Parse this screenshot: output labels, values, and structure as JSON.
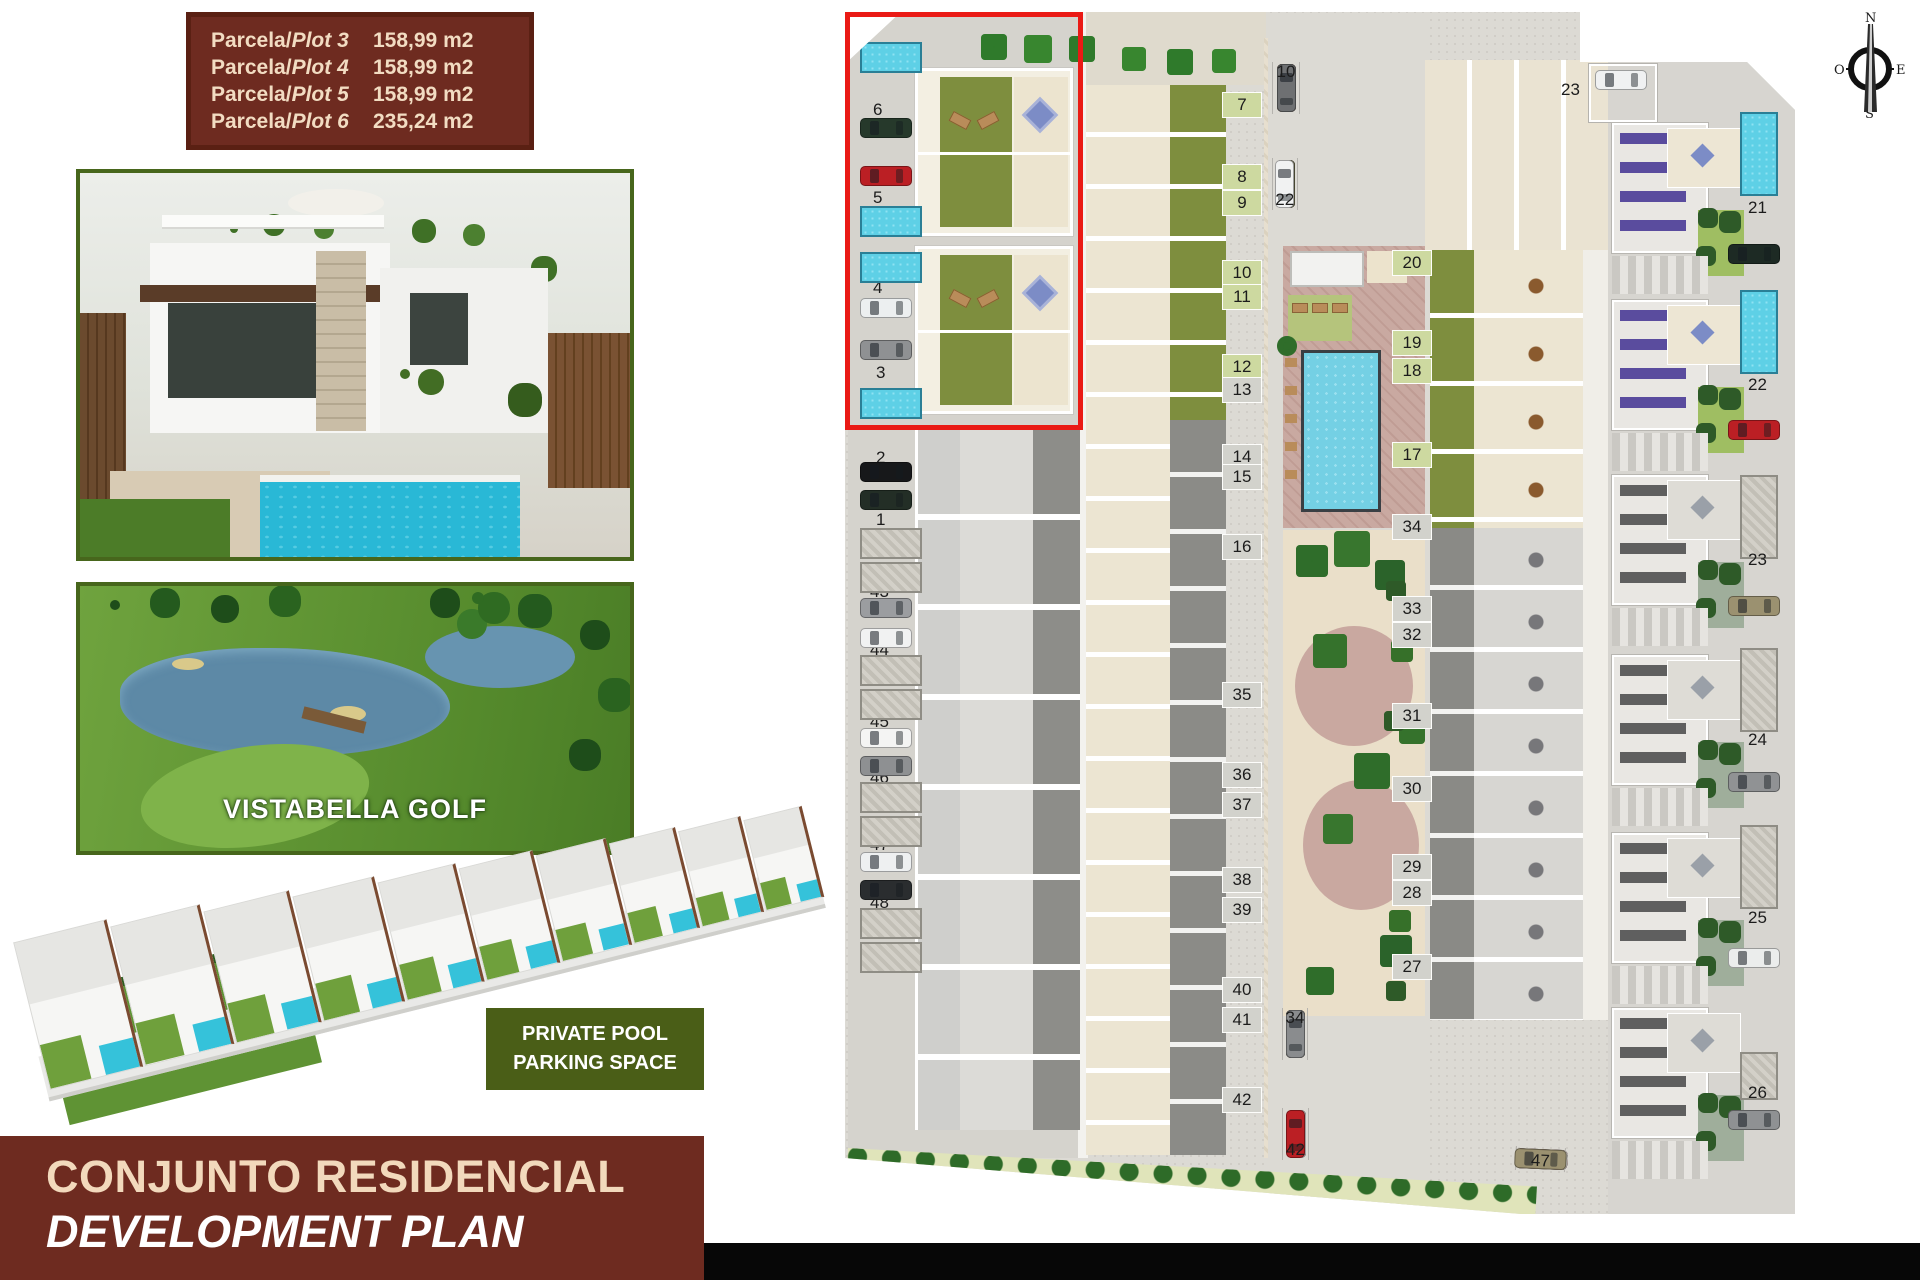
{
  "title_block": {
    "rows": [
      {
        "prefix": "Parcela/",
        "plot": "Plot 3",
        "area": "158,99  m2"
      },
      {
        "prefix": "Parcela/",
        "plot": "Plot 4",
        "area": "158,99  m2"
      },
      {
        "prefix": "Parcela/",
        "plot": "Plot 5",
        "area": "158,99  m2"
      },
      {
        "prefix": "Parcela/",
        "plot": "Plot 6",
        "area": "235,24  m2"
      }
    ]
  },
  "golf_photo": {
    "caption": "VISTABELLA GOLF"
  },
  "feature_box": {
    "line1": "PRIVATE POOL",
    "line2": "PARKING SPACE"
  },
  "footer": {
    "title_es": "CONJUNTO RESIDENCIAL",
    "title_en": "DEVELOPMENT PLAN"
  },
  "compass": {
    "north": "N",
    "south": "S",
    "east": "E",
    "west": "O"
  },
  "colors": {
    "brand_brown": "#6e2b20",
    "cream_text": "#f2d9bc",
    "olive_green": "#4a5e17",
    "highlight_red": "#ea1a15",
    "pool_blue": "#5ed0e6",
    "garden_green": "#7e8e3e"
  },
  "plan": {
    "top_right_parking": {
      "n": "23"
    },
    "highlight_plots": [
      "3",
      "4",
      "5",
      "6"
    ],
    "left_labels": [
      {
        "n": "6",
        "x": 30,
        "y": 92
      },
      {
        "n": "5",
        "x": 30,
        "y": 180
      },
      {
        "n": "4",
        "x": 30,
        "y": 270
      },
      {
        "n": "3",
        "x": 33,
        "y": 355
      },
      {
        "n": "2",
        "x": 33,
        "y": 440
      },
      {
        "n": "1",
        "x": 33,
        "y": 502
      },
      {
        "n": "43",
        "x": 27,
        "y": 574
      },
      {
        "n": "44",
        "x": 27,
        "y": 632
      },
      {
        "n": "45",
        "x": 27,
        "y": 704
      },
      {
        "n": "46",
        "x": 27,
        "y": 760
      },
      {
        "n": "47",
        "x": 27,
        "y": 827
      },
      {
        "n": "48",
        "x": 27,
        "y": 885
      }
    ],
    "left_cars": [
      {
        "x": 17,
        "y": 110,
        "c": "#26392b"
      },
      {
        "x": 17,
        "y": 158,
        "c": "#bb1f24"
      },
      {
        "x": 17,
        "y": 290,
        "c": "#eceff0"
      },
      {
        "x": 17,
        "y": 332,
        "c": "#8f9193"
      },
      {
        "x": 17,
        "y": 454,
        "c": "#17181a"
      },
      {
        "x": 17,
        "y": 482,
        "c": "#232e26"
      },
      {
        "x": 17,
        "y": 590,
        "c": "#9b9da0"
      },
      {
        "x": 17,
        "y": 620,
        "c": "#f1f2f2"
      },
      {
        "x": 17,
        "y": 720,
        "c": "#f4f4f3"
      },
      {
        "x": 17,
        "y": 748,
        "c": "#8e9092"
      },
      {
        "x": 17,
        "y": 844,
        "c": "#eef0f1"
      },
      {
        "x": 17,
        "y": 872,
        "c": "#2a2d2f"
      }
    ],
    "left_pools": [
      {
        "x": 17,
        "y": 34,
        "cls": "b"
      },
      {
        "x": 17,
        "y": 198,
        "cls": "b"
      },
      {
        "x": 17,
        "y": 244,
        "cls": "b"
      },
      {
        "x": 17,
        "y": 380,
        "cls": "b"
      },
      {
        "x": 17,
        "y": 520,
        "cls": "g"
      },
      {
        "x": 17,
        "y": 554,
        "cls": "g"
      },
      {
        "x": 17,
        "y": 647,
        "cls": "g"
      },
      {
        "x": 17,
        "y": 681,
        "cls": "g"
      },
      {
        "x": 17,
        "y": 774,
        "cls": "g"
      },
      {
        "x": 17,
        "y": 808,
        "cls": "g"
      },
      {
        "x": 17,
        "y": 900,
        "cls": "g"
      },
      {
        "x": 17,
        "y": 934,
        "cls": "g"
      }
    ],
    "hl_buildings": [
      {
        "y": 60
      },
      {
        "y": 238
      }
    ],
    "mid_tabs": [
      {
        "n": "7",
        "y": 84,
        "g": 1
      },
      {
        "n": "8",
        "y": 156,
        "g": 1
      },
      {
        "n": "9",
        "y": 182,
        "g": 1
      },
      {
        "n": "10",
        "y": 252,
        "g": 1
      },
      {
        "n": "11",
        "y": 276,
        "g": 1
      },
      {
        "n": "12",
        "y": 346,
        "g": 1
      },
      {
        "n": "13",
        "y": 369
      },
      {
        "n": "14",
        "y": 436
      },
      {
        "n": "15",
        "y": 456
      },
      {
        "n": "16",
        "y": 526
      },
      {
        "n": "35",
        "y": 674
      },
      {
        "n": "36",
        "y": 754
      },
      {
        "n": "37",
        "y": 784
      },
      {
        "n": "38",
        "y": 859
      },
      {
        "n": "39",
        "y": 889
      },
      {
        "n": "40",
        "y": 969
      },
      {
        "n": "41",
        "y": 999
      },
      {
        "n": "42",
        "y": 1079
      }
    ],
    "cr_tabs": [
      {
        "n": "20",
        "y": 242,
        "g": 1
      },
      {
        "n": "19",
        "y": 322,
        "g": 1
      },
      {
        "n": "18",
        "y": 350,
        "g": 1
      },
      {
        "n": "17",
        "y": 434,
        "g": 1
      },
      {
        "n": "34",
        "y": 506
      },
      {
        "n": "33",
        "y": 588
      },
      {
        "n": "32",
        "y": 614
      },
      {
        "n": "31",
        "y": 695
      },
      {
        "n": "30",
        "y": 768
      },
      {
        "n": "29",
        "y": 846
      },
      {
        "n": "28",
        "y": 872
      },
      {
        "n": "27",
        "y": 946
      }
    ],
    "park_row1": [
      {
        "n": "1",
        "c": "#bb1f24"
      },
      {
        "n": "2",
        "c": "#f1f2f2"
      },
      {
        "n": "3",
        "c": "#9b9170"
      },
      {
        "n": "4",
        "c": "#6e7072"
      },
      {
        "n": "5",
        "c": "#f1f2f2"
      },
      {
        "n": "6",
        "c": "#1f3527"
      },
      {
        "n": "7",
        "c": "#bb1f24"
      },
      {
        "n": "8",
        "c": "#f1f2f2"
      },
      {
        "n": "9",
        "c": "#9b9170"
      },
      {
        "n": "10",
        "c": "#6e7072"
      }
    ],
    "park_row2": [
      {
        "n": "11",
        "c": "#7a7c7e"
      },
      {
        "n": "12",
        "c": "#1f3527"
      },
      {
        "n": "13",
        "c": "#f1f2f2"
      },
      {
        "n": "14",
        "c": "#6e7072"
      },
      {
        "n": "15",
        "c": "#bb1f24"
      },
      {
        "n": "16",
        "c": "#9b9170"
      },
      {
        "n": "17",
        "c": "#1f3527"
      },
      {
        "n": "18",
        "c": "#f1f2f2"
      },
      {
        "n": "19",
        "c": "#9b9170"
      },
      {
        "n": "20",
        "c": "#7a7c7e"
      },
      {
        "n": "21",
        "c": "#6b6b4a"
      },
      {
        "n": "22",
        "c": "#f1f2f2"
      }
    ],
    "park_row3": [
      {
        "n": "24",
        "c": "#f1f2f2"
      },
      {
        "n": "25",
        "c": "#9b9170"
      },
      {
        "n": "26",
        "c": "#8a8c8e"
      },
      {
        "n": "27",
        "c": "#f1f2f2"
      },
      {
        "n": "28",
        "c": "#1f3527"
      },
      {
        "n": "29",
        "c": "#9b9170"
      },
      {
        "n": "30",
        "c": "#bb1f24"
      },
      {
        "n": "31",
        "c": "#8a8c8e"
      },
      {
        "n": "32",
        "c": "#f1f2f2"
      },
      {
        "n": "33",
        "c": "#1f3527"
      },
      {
        "n": "34",
        "c": "#8a8c8e"
      }
    ],
    "park_row4": [
      {
        "n": "35",
        "c": "#8a8c8e"
      },
      {
        "n": "36",
        "c": "#f1f2f2"
      },
      {
        "n": "37",
        "c": "#bb1f24"
      },
      {
        "n": "38",
        "c": "#1f3527"
      },
      {
        "n": "39",
        "c": "#f1f2f2"
      },
      {
        "n": "40",
        "c": "#8a8c8e"
      },
      {
        "n": "41",
        "c": "#f1f2f2"
      },
      {
        "n": "42",
        "c": "#bb1f24"
      }
    ],
    "park_row5": [
      {
        "n": "43",
        "c": "#f1f2f2"
      },
      {
        "n": "44",
        "c": "#26352a"
      },
      {
        "n": "45",
        "c": "#bb1f24"
      },
      {
        "n": "46",
        "c": "#f0f0ef"
      },
      {
        "n": "47",
        "c": "#9b9170"
      }
    ],
    "right_villas": [
      {
        "n": "21",
        "y": 190
      },
      {
        "n": "22",
        "y": 367
      },
      {
        "n": "23",
        "y": 542
      },
      {
        "n": "24",
        "y": 722
      },
      {
        "n": "25",
        "y": 900
      },
      {
        "n": "26",
        "y": 1075
      }
    ],
    "right_blocks": [
      {
        "y": 112,
        "p": "#5a4c9e",
        "g": 1
      },
      {
        "y": 289,
        "p": "#5a4c9e",
        "g": 1
      },
      {
        "y": 464,
        "p": "#5f5f5f"
      },
      {
        "y": 644,
        "p": "#5f5f5f"
      },
      {
        "y": 822,
        "p": "#5f5f5f"
      },
      {
        "y": 997,
        "p": "#5f5f5f"
      }
    ],
    "right_pools": [
      {
        "y": 104,
        "cls": "b"
      },
      {
        "y": 282,
        "cls": "b"
      },
      {
        "y": 467,
        "cls": "g"
      },
      {
        "y": 640,
        "cls": "g"
      },
      {
        "y": 817,
        "cls": "g"
      },
      {
        "y": 1044,
        "cls": "g",
        "h": 48
      }
    ],
    "right_cars": [
      {
        "y": 236,
        "c": "#1d2a24"
      },
      {
        "y": 412,
        "c": "#bb1f24"
      },
      {
        "y": 588,
        "c": "#9b9170"
      },
      {
        "y": 764,
        "c": "#909294"
      },
      {
        "y": 940,
        "c": "#ebedec"
      },
      {
        "y": 1102,
        "c": "#8f9193"
      }
    ],
    "r3d_units": [
      {
        "w": 92,
        "h": 150
      },
      {
        "w": 88,
        "h": 142
      },
      {
        "w": 84,
        "h": 134
      },
      {
        "w": 80,
        "h": 127
      },
      {
        "w": 76,
        "h": 120
      },
      {
        "w": 72,
        "h": 114
      },
      {
        "w": 68,
        "h": 108
      },
      {
        "w": 64,
        "h": 102
      },
      {
        "w": 60,
        "h": 97
      },
      {
        "w": 56,
        "h": 92
      }
    ]
  }
}
